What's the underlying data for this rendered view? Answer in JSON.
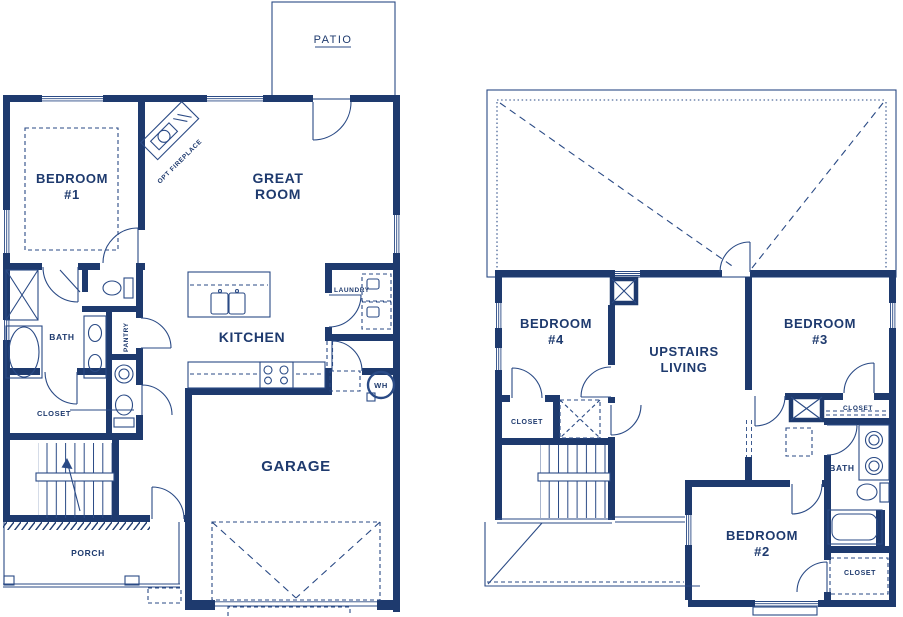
{
  "title": "Two-story house floor plan",
  "colors": {
    "wall": "#1e3a6e",
    "line": "#2a4a85",
    "background": "#ffffff"
  },
  "first_floor": {
    "patio": "PATIO",
    "bedroom1_line1": "BEDROOM",
    "bedroom1_line2": "#1",
    "great_room_line1": "GREAT",
    "great_room_line2": "ROOM",
    "fireplace": "OPT FIREPLACE",
    "bath": "BATH",
    "pantry": "PANTRY",
    "kitchen": "KITCHEN",
    "laundry": "LAUNDRY",
    "closet": "CLOSET",
    "water_heater": "WH",
    "garage": "GARAGE",
    "porch": "PORCH"
  },
  "second_floor": {
    "bedroom4_line1": "BEDROOM",
    "bedroom4_line2": "#4",
    "upstairs_living_line1": "UPSTAIRS",
    "upstairs_living_line2": "LIVING",
    "bedroom3_line1": "BEDROOM",
    "bedroom3_line2": "#3",
    "bedroom2_line1": "BEDROOM",
    "bedroom2_line2": "#2",
    "closet_bedroom4": "CLOSET",
    "closet_bedroom3": "CLOSET",
    "closet_bedroom2": "CLOSET",
    "bath": "BATH"
  }
}
